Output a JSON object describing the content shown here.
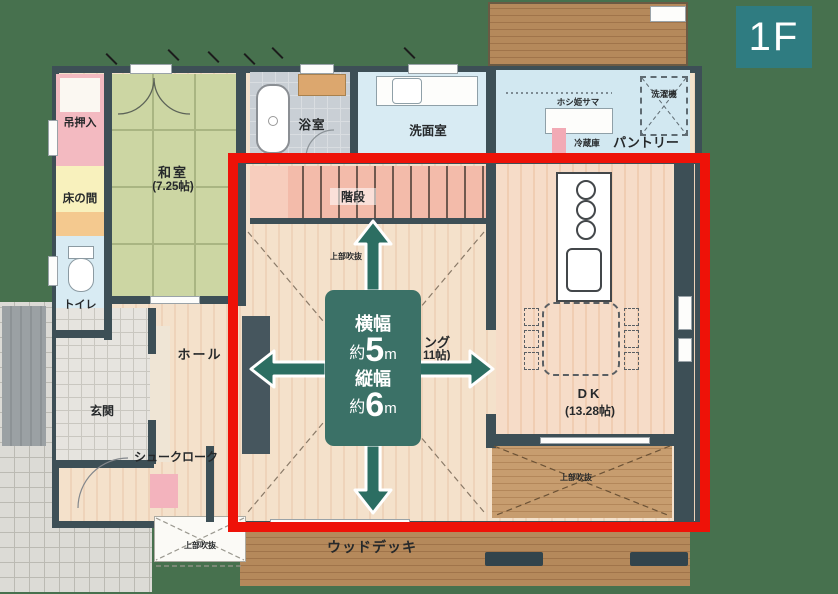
{
  "floor_badge": {
    "label": "1F"
  },
  "dimension_box": {
    "width_title": "横幅",
    "width_approx": "約",
    "width_num": "5",
    "width_unit": "m",
    "height_title": "縦幅",
    "height_approx": "約",
    "height_num": "6",
    "height_unit": "m"
  },
  "rooms": {
    "tsuri_oshiire": "吊押入",
    "washitsu_name": "和室",
    "washitsu_size": "(7.25帖)",
    "tokonoma": "床の間",
    "toilet": "トイレ",
    "bathroom": "浴室",
    "washroom": "洗面室",
    "hoshihime": "ホシ姫サマ",
    "washer": "洗濯機",
    "fridge": "冷蔵庫",
    "pantry": "パントリー",
    "stairs": "階段",
    "void_under_stairs": "上部吹抜",
    "living_partial_line1": "ング",
    "living_partial_line2": "11帖)",
    "dk_name": "DK",
    "dk_size": "(13.28帖)",
    "hall": "ホール",
    "genkan": "玄関",
    "shoe_cloak": "シュークローク",
    "void_porch": "上部吹抜",
    "void_dk": "上部吹抜",
    "wood_deck": "ウッドデッキ"
  },
  "colors": {
    "background": "#47714e",
    "red_frame": "#ee1208",
    "annotation_teal": "#3b7167",
    "arrow_teal": "#2c6e62",
    "badge_teal": "#2f7c81",
    "wall": "#3d4f56",
    "tatami_green": "#ccd6a3",
    "wood_floor": "#f3dfc9",
    "deck_brown": "#b5895b",
    "water_blue": "#d8ebf3",
    "stairs_pink": "#f3bbaa"
  }
}
